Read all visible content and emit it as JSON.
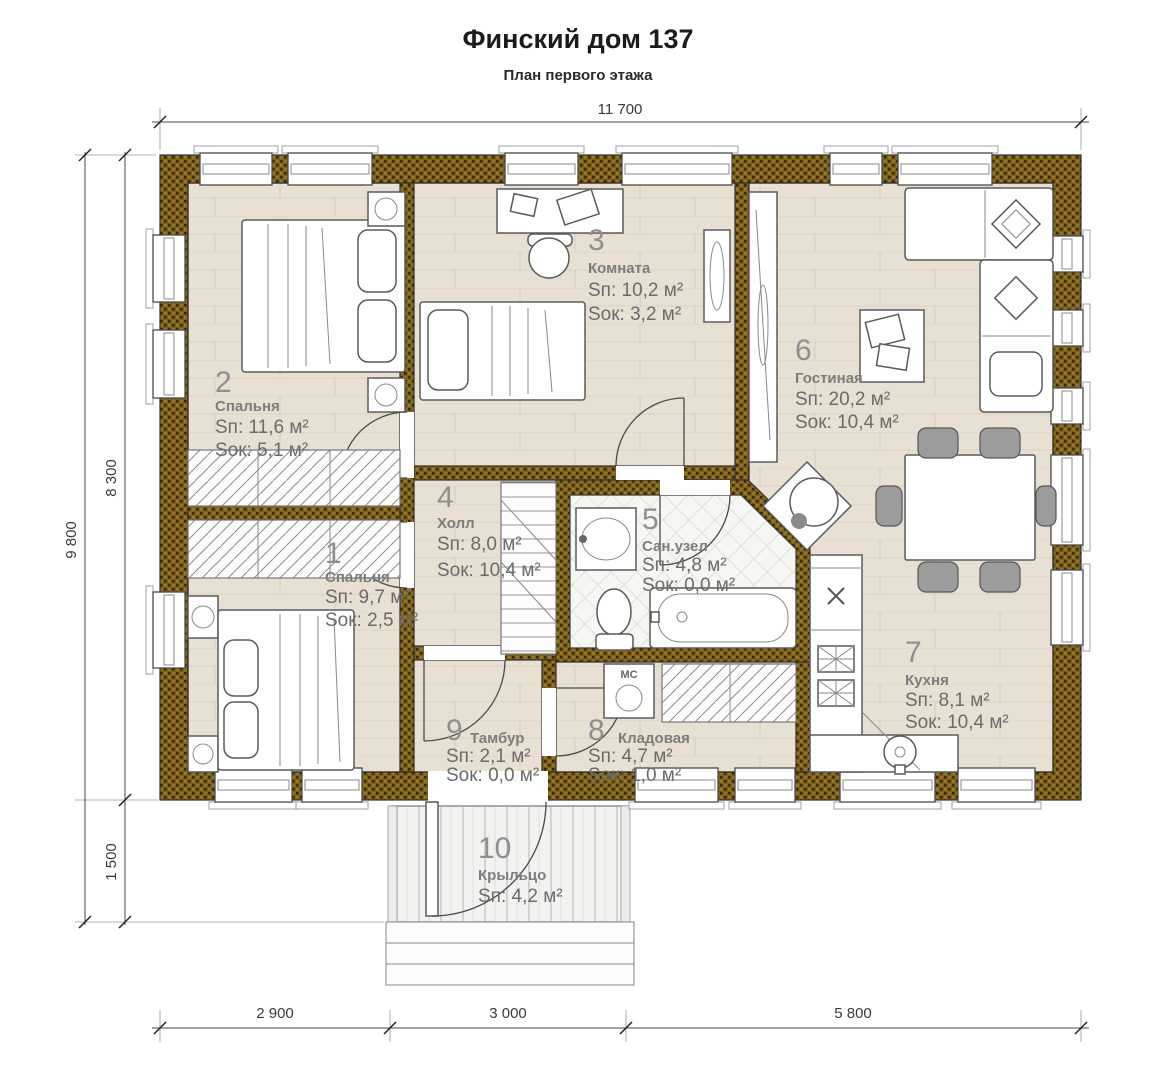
{
  "title": "Финский дом 137",
  "subtitle": "План первого этажа",
  "dimensions": {
    "top": "11 700",
    "left_total": "9 800",
    "left_house": "8 300",
    "left_porch": "1 500",
    "bottom_segments": [
      "2 900",
      "3 000",
      "5 800"
    ]
  },
  "rooms": [
    {
      "number": "1",
      "name": "Спальня",
      "area_floor": "Sп: 9,7 м²",
      "area_window": "Sок: 2,5 м²"
    },
    {
      "number": "2",
      "name": "Спальня",
      "area_floor": "Sп: 11,6 м²",
      "area_window": "Sок: 5,1 м²"
    },
    {
      "number": "3",
      "name": "Комната",
      "area_floor": "Sп: 10,2 м²",
      "area_window": "Sок: 3,2 м²"
    },
    {
      "number": "4",
      "name": "Холл",
      "area_floor": "Sп: 8,0 м²",
      "area_window": "Sок: 10,4 м²"
    },
    {
      "number": "5",
      "name": "Сан.узел",
      "area_floor": "Sп: 4,8 м²",
      "area_window": "Sок: 0,0 м²"
    },
    {
      "number": "6",
      "name": "Гостиная",
      "area_floor": "Sп: 20,2 м²",
      "area_window": "Sок: 10,4 м²"
    },
    {
      "number": "7",
      "name": "Кухня",
      "area_floor": "Sп: 8,1 м²",
      "area_window": "Sок: 10,4 м²"
    },
    {
      "number": "8",
      "name": "Кладовая",
      "area_floor": "Sп: 4,7 м²",
      "area_window": "Sок: 1,0 м²"
    },
    {
      "number": "9",
      "name": "Тамбур",
      "area_floor": "Sп: 2,1 м²",
      "area_window": "Sок: 0,0 м²"
    },
    {
      "number": "10",
      "name": "Крыльцо",
      "area_floor": "Sп: 4,2 м²",
      "area_window": ""
    }
  ],
  "labels": {
    "washing_machine": "МС"
  },
  "colors": {
    "wall": "#7e6019",
    "wall_dot": "#33280a",
    "floor": "#e8e0d3",
    "tile": "#f6f6f2"
  }
}
